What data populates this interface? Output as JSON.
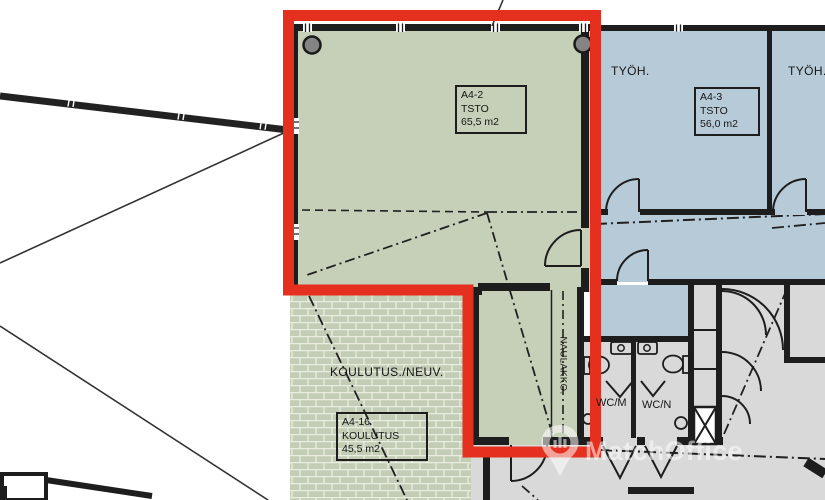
{
  "plan": {
    "room_boxes": [
      {
        "id": "A4-2",
        "use": "TSTO",
        "area": "65,5 m2"
      },
      {
        "id": "A4-3",
        "use": "TSTO",
        "area": "56,0 m2"
      },
      {
        "id": "A4-16",
        "use": "KOULUTUS",
        "area": "45,5 m2"
      }
    ],
    "room_labels": {
      "tyoh_left": "TYÖH.",
      "tyoh_right": "TYÖH.",
      "koulutus_neuv": "KOULUTUS./NEUV.",
      "wc_m": "WC/M",
      "wc_n": "WC/N",
      "naulakko": "NAULAKKO."
    },
    "colors": {
      "highlight_red": "#e5301f",
      "office_green": "#c6d0b8",
      "training_green": "#c3cdb6",
      "office_blue": "#b7cad8",
      "neutral_gray": "#d9d9d9",
      "wall": "#1d1d1d"
    }
  },
  "watermark": {
    "brand": "MatchOffice"
  }
}
